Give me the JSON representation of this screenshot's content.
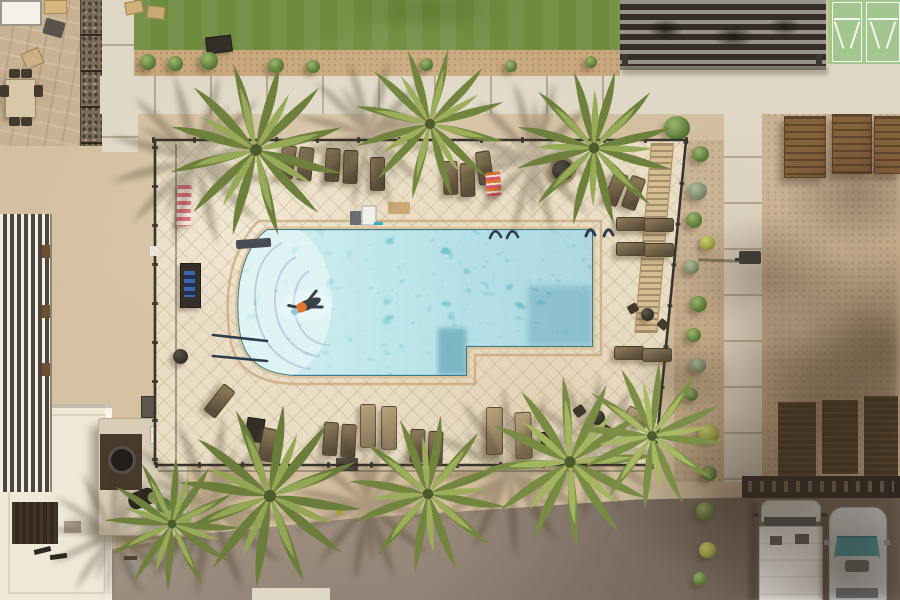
{
  "scene": {
    "type": "aerial-photograph",
    "title": "Aerial view of a community swimming pool",
    "description": "Top-down drone photo of a fenced resort-style swimming pool with a curved step entry and one swimmer, tan diamond-paver deck with brown lounge chairs and striped towels, palm trees casting shadows to the west, an artificial turf lawn, slatted pergola and shuffleboard courts along the top, a gabion wall and patio dining sets at top left, a rooftop and outdoor kitchen with a saguaro cactus at bottom left, a driveway, and a parking area at bottom right with a white van and a silver car under a large tree shadow.",
    "setting": "sunny daytime, shadows cast toward lower-left",
    "counts": {
      "palm_trees": 8,
      "swimmers": 1,
      "vehicles": 2,
      "lounge_chairs": 24,
      "shuffleboard_courts": 2
    },
    "objects": [
      "swimming pool",
      "curved pool steps",
      "pool handrails",
      "swimmer",
      "pool fence",
      "paver pool deck",
      "lounge chairs",
      "side tables",
      "fire pit",
      "towel cabinet",
      "pink striped towel",
      "orange striped towel",
      "pool cart",
      "palm trees",
      "saguaro cactus",
      "artificial turf",
      "shuffleboard courts",
      "slatted pergola",
      "patio dining set",
      "gabion wall",
      "outdoor kitchen",
      "street lamp",
      "wooden benches",
      "parking wall",
      "white van",
      "silver car",
      "asphalt driveway",
      "sidewalks",
      "desert shrubs",
      "large tree shadow"
    ],
    "colors": {
      "sand": "#d4c0a1",
      "dirt": "#c5ad8c",
      "gravel": "#c9a87d",
      "concrete": "#e0d8c7",
      "deck": "#e9ddc5",
      "coping": "#ddc29a",
      "turf": "#6f8c3e",
      "court_green": "#a2c68e",
      "pool_shallow": "#83d2d3",
      "pool_mid": "#4fbdc9",
      "pool_deep": "#27a2b6",
      "fence_dark": "#38342e",
      "palm_green": "#6d803c",
      "palm_light": "#97aa57",
      "shadow_brown": "#3c3022",
      "asphalt_light": "#97897c",
      "asphalt_dark": "#6b6057",
      "wood_bench": "#85613c",
      "wall_dark": "#2a2520",
      "van_white": "#edebe6",
      "car_silver": "#c9ccce",
      "windshield_teal": "#3f8f99",
      "towel_pink": "#e2717c",
      "towel_blue": "#3c64b2"
    }
  }
}
